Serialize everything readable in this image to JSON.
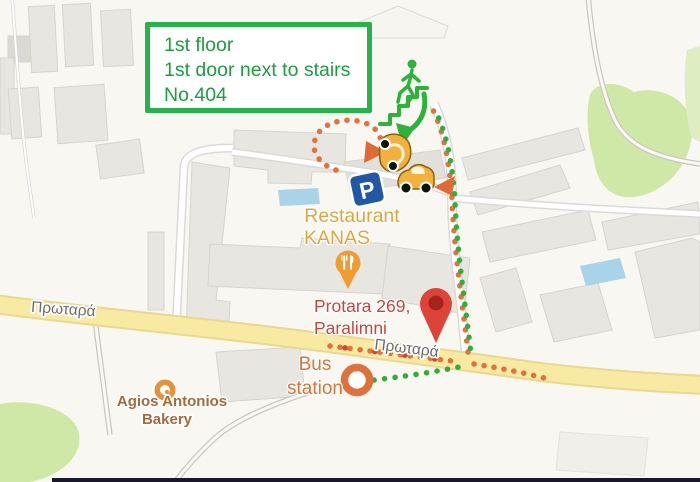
{
  "note_box": {
    "lines": [
      "1st floor",
      "1st door next to stairs",
      "No.404"
    ]
  },
  "pois": {
    "restaurant": {
      "name_line1": "Restaurant",
      "name_line2": "KANAS"
    },
    "destination": {
      "address_line1": "Protara 269,",
      "address_line2": "Paralimni"
    },
    "bus_station": {
      "label_line1": "Bus",
      "label_line2": "station"
    },
    "bakery": {
      "name_line1": "Agios Antonios",
      "name_line2": "Bakery"
    }
  },
  "streets": {
    "protara_left": "Πρωταρά",
    "protara_center": "Πρωταρά"
  },
  "icons": {
    "parking_sign_letter": "P",
    "stairs_person": "person-climbing-stairs-icon",
    "car_top": "car-top-view-icon",
    "car_side": "car-side-view-icon",
    "destination_pin": "red-map-pin-icon",
    "restaurant_pin": "restaurant-fork-knife-pin-icon",
    "bus_circle": "bus-stop-circle-icon",
    "bakery_poi": "bakery-poi-icon"
  },
  "colors": {
    "note_green": "#25b34a",
    "note_text_green": "#1aa03c",
    "route_walk_green": "#2fae3b",
    "route_drive_orange": "#e4703a",
    "destination_red": "#d0433a",
    "restaurant_label": "#e3a43b",
    "bus_label": "#dd7138",
    "bakery_label": "#a56a3a",
    "street_label": "#6b6b6b",
    "road_yellow": "#f8eaa3",
    "parking_blue": "#2257a5"
  }
}
